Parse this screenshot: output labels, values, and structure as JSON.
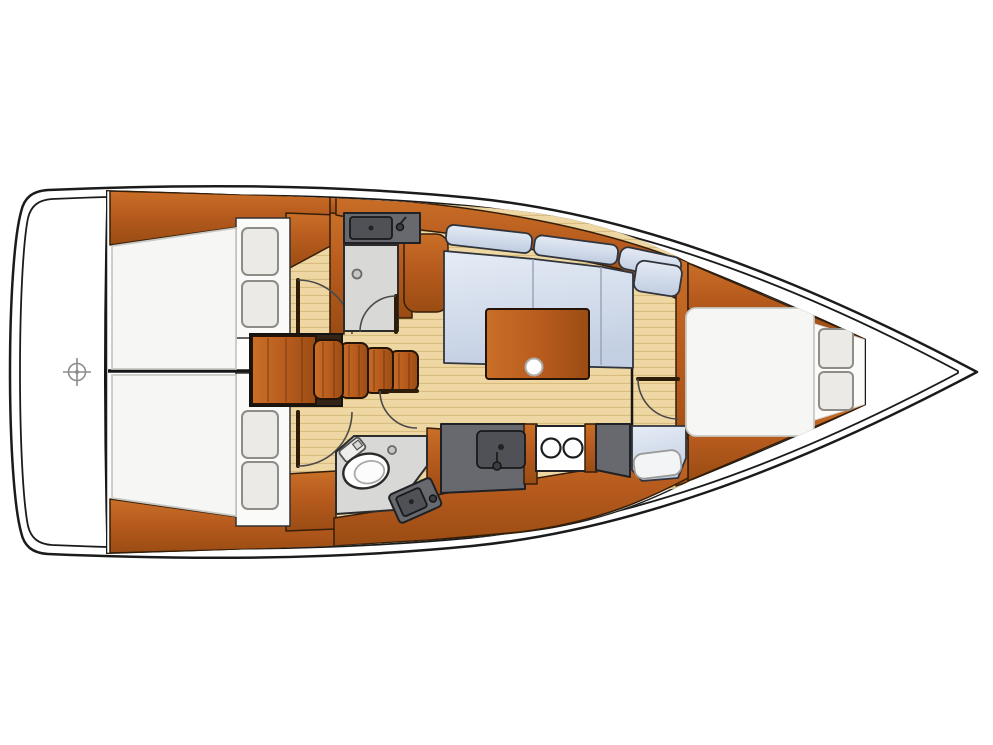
{
  "diagram": {
    "kind": "sailboat interior floor plan, top view, bow pointing right",
    "areas": {
      "stern_deck": "stern platform with helm position marker",
      "aft_cabin_port": "aft double-berth cabin with two pillows and closet (top left)",
      "aft_cabin_starboard": "aft double-berth cabin with two pillows and closet (bottom left)",
      "companionway": "companionway steps with engine box",
      "shower_room": "shower compartment with sink counter and drain (aft top)",
      "toilet_room": "head with marine toilet and angled washbasin console (bottom)",
      "galley": "linear galley with sink and two-burner stove (bottom)",
      "salon": "L-shaped settee, saloon table and mast post",
      "nav_seat": "forward starboard seat",
      "forward_cabin": "V-berth double cabin with two pillows (bow)"
    }
  },
  "colors": {
    "hull_line": "#1b1b1b",
    "wood": "#b75b1e",
    "wood_dark": "#9a4c13",
    "wood_light": "#c96f27",
    "wood_edge": "#351e08",
    "floor": "#eed7a2",
    "floor_line": "#d9bc80",
    "cushion": "#e6ecf6",
    "cushion_dark": "#c3cfe2",
    "cushion_edge": "#30343c",
    "bed": "#f6f6f4",
    "bed_edge": "#c9c9c4",
    "pillow": "#eceae6",
    "pillow_edge": "#8e8c86",
    "counter": "#67696e",
    "counter_dark": "#4f5156",
    "counter_edge": "#1f2124",
    "shower": "#d8d8d6",
    "shower_edge": "#2c2c2c",
    "stove": "#ffffff"
  }
}
